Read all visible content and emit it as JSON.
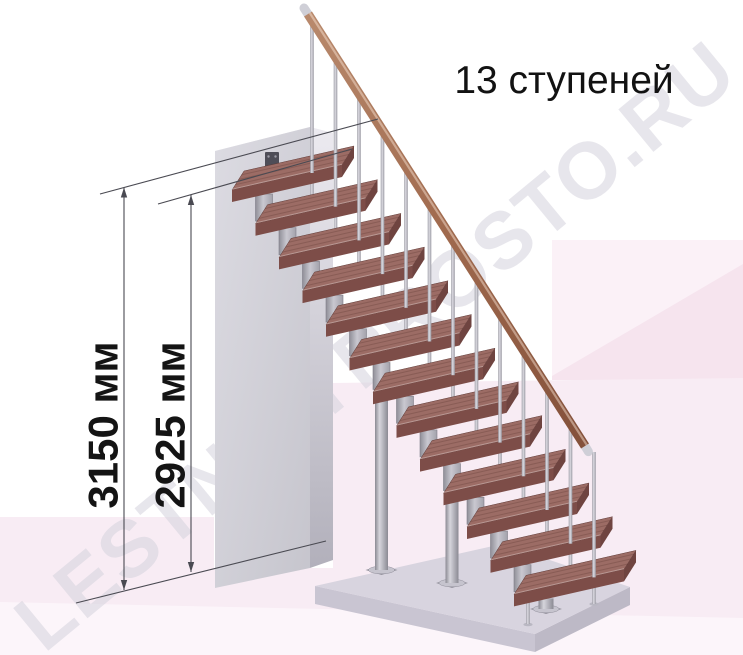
{
  "title": "13 ступеней",
  "watermark": "LESTNICYPROSTO.RU",
  "dimensions": {
    "outer": "3150 мм",
    "inner": "2925 мм"
  },
  "stairs": {
    "step_count": 13,
    "baluster_count": 13
  },
  "colors": {
    "tread_top": "#9c6c65",
    "tread_front": "#7d4d48",
    "tread_side": "#6f4440",
    "tread_edge": "#5f3a36",
    "handrail_light": "#b98a6d",
    "handrail_mid": "#a06a4e",
    "handrail_dark": "#83503a",
    "ferrule": "#cfcfd7",
    "metal_dark": "#8b8a93",
    "metal_light": "#d6d5dc",
    "metal_mid": "#a8a7b0",
    "wall_top": "#f1f0f4",
    "wall_front_light": "#dcdbe2",
    "wall_front_dark": "#c6c5cd",
    "wall_side_light": "#eceaf0",
    "wall_side_dark": "#b2b0bb",
    "bracket_plate": "#4e4d57",
    "platform_top": "#d8d4df",
    "platform_left": "#c9c5d2",
    "platform_right": "#bdb9c6",
    "base_pad": "#96949f",
    "base_ellipse": "#c6c4ce",
    "bg_pink": "#f8ecf4",
    "bg_pink_panel": "#f6e4ee",
    "bg_pink_light": "#fbf1f7",
    "bg_pink_strip": "#fcf5fa",
    "dim_line": "#4a4a52",
    "watermark_color": "#d5d3dd"
  }
}
